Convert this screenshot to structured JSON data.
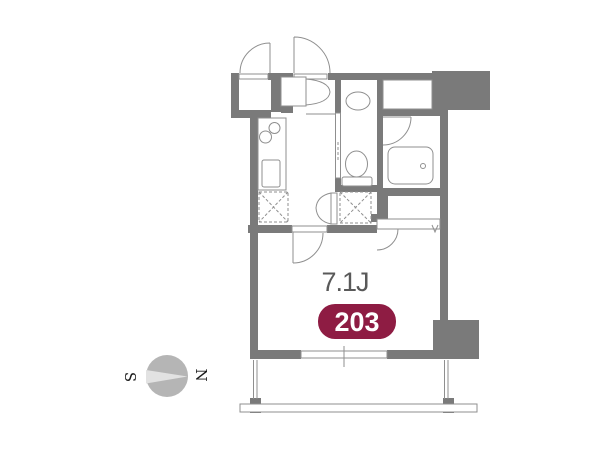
{
  "floor_plan": {
    "room_size_label": "7.1J",
    "unit_number": "203",
    "compass": {
      "south_label": "S",
      "north_label": "N"
    }
  },
  "colors": {
    "background": "#ffffff",
    "wall": "#7a7a7a",
    "line": "#8f8f8f",
    "badge_bg": "#8e1c43",
    "badge_text": "#ffffff",
    "room_label_text": "#595959",
    "compass_circle": "#b5b5b5",
    "compass_needle": "#e2e2e2",
    "compass_text": "#1a1a1a"
  }
}
